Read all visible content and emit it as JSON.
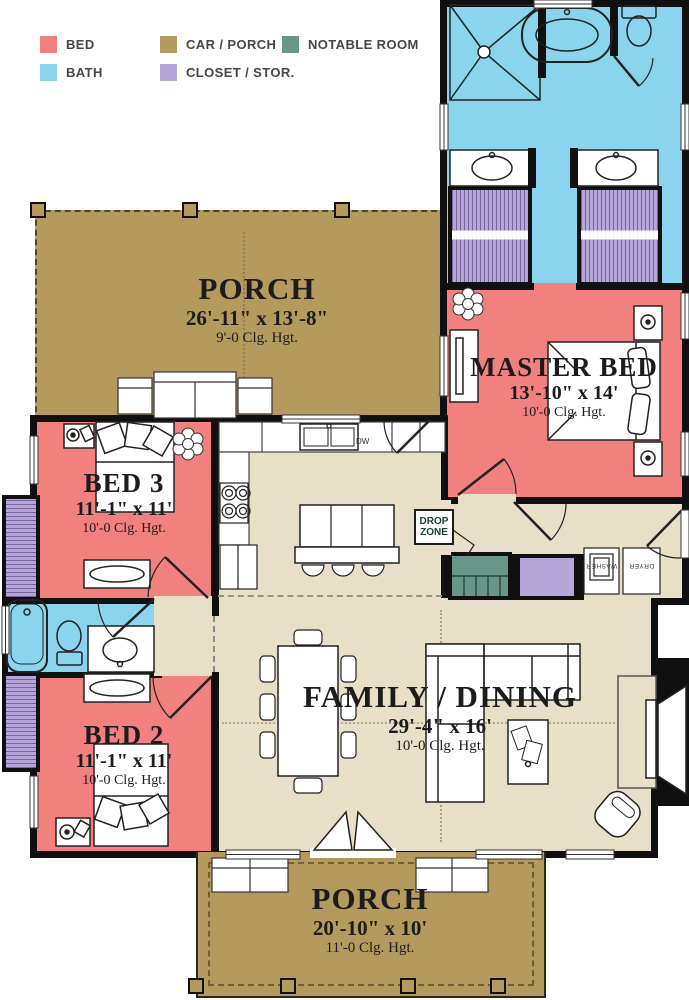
{
  "legend": {
    "items": [
      {
        "label": "BED",
        "color": "#f2807e"
      },
      {
        "label": "CAR / PORCH",
        "color": "#b49a5c"
      },
      {
        "label": "NOTABLE ROOM",
        "color": "#68978a"
      },
      {
        "label": "BATH",
        "color": "#8ad4ee"
      },
      {
        "label": "CLOSET / STOR.",
        "color": "#b5a5d9"
      }
    ]
  },
  "rooms": {
    "porch_top": {
      "name": "PORCH",
      "dims": "26'-11\" x 13'-8\"",
      "ceiling": "9'-0 Clg. Hgt."
    },
    "master_bed": {
      "name": "MASTER BED",
      "dims": "13'-10\" x 14'",
      "ceiling": "10'-0 Clg. Hgt."
    },
    "bed_3": {
      "name": "BED 3",
      "dims": "11'-1\" x 11'",
      "ceiling": "10'-0 Clg. Hgt."
    },
    "bed_2": {
      "name": "BED 2",
      "dims": "11'-1\" x 11'",
      "ceiling": "10'-0 Clg. Hgt."
    },
    "family_dining": {
      "name": "FAMILY / DINING",
      "dims": "29'-4\" x 16'",
      "ceiling": "10'-0 Clg. Hgt."
    },
    "porch_bottom": {
      "name": "PORCH",
      "dims": "20'-10\" x 10'",
      "ceiling": "11'-0 Clg. Hgt."
    }
  },
  "annotations": {
    "drop_zone_line1": "DROP",
    "drop_zone_line2": "ZONE",
    "dishwasher": "DW",
    "washer": "WASHER",
    "dryer": "DRYER"
  },
  "colors": {
    "bed": "#f2807e",
    "bath": "#8ad4ee",
    "porch": "#b49a5c",
    "closet": "#b5a5d9",
    "notable": "#68978a",
    "floor": "#e8dfc9",
    "wall": "#101010"
  }
}
